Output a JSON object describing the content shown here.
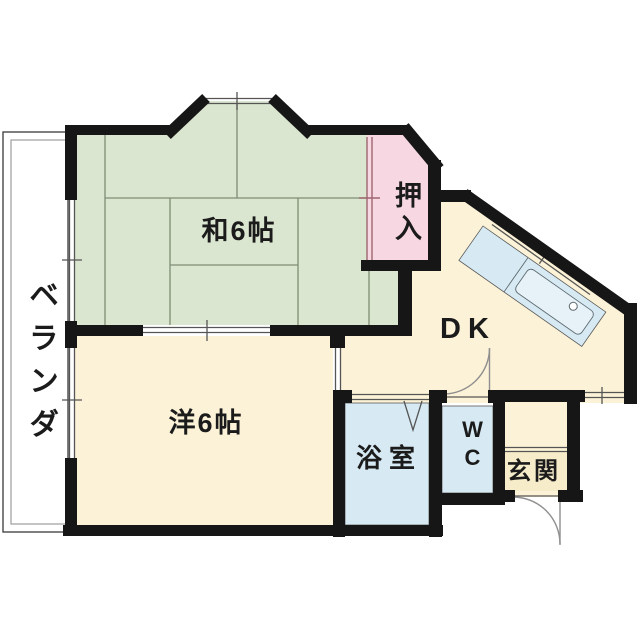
{
  "floor_plan": {
    "labels": {
      "veranda": "ベランダ",
      "japanese_room": "和6帖",
      "closet": "押入",
      "dining_kitchen": "DK",
      "western_room": "洋6帖",
      "bathroom": "浴室",
      "toilet": "WC",
      "entrance": "玄関"
    },
    "colors": {
      "wall": "#161616",
      "tatami_green": "#dbe6d0",
      "room_cream": "#fcf2d7",
      "closet_pink": "#f7d7e2",
      "water_blue": "#d7eaf3",
      "sink_blue": "#e6f2f8",
      "genkan_tile": "#f6ecca",
      "line_thin": "#555555",
      "mat_line": "#7f8e74",
      "door_arc": "#8f8f8f",
      "closet_door": "#9d6570",
      "text": "#1b1b1b"
    }
  }
}
